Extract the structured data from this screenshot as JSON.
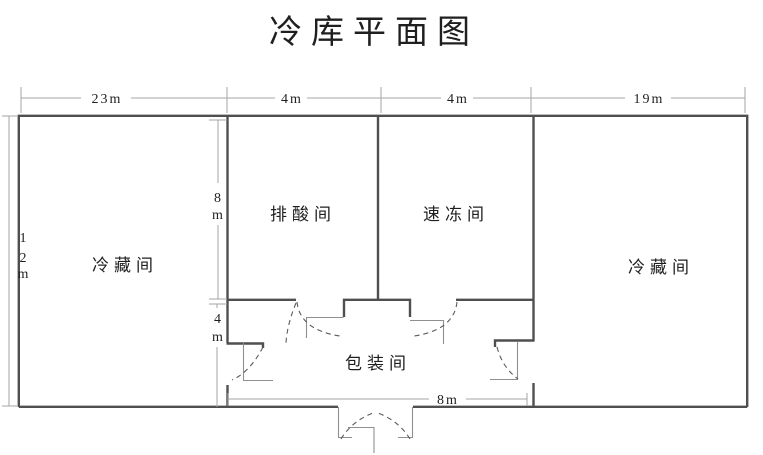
{
  "title": "冷库平面图",
  "dimensions": {
    "top": [
      {
        "label": "23m"
      },
      {
        "label": "4m"
      },
      {
        "label": "4m"
      },
      {
        "label": "19m"
      }
    ],
    "left": {
      "label": "12m",
      "chars": [
        "1",
        "2",
        "m"
      ]
    },
    "middle_upper": {
      "label": "8m",
      "chars": [
        "8",
        "m"
      ]
    },
    "middle_lower": {
      "label": "4m",
      "chars": [
        "4",
        "m"
      ]
    },
    "bottom": {
      "label": "8m"
    }
  },
  "rooms": {
    "left_cold_storage": "冷藏间",
    "acid_removal": "排酸间",
    "quick_freeze": "速冻间",
    "right_cold_storage": "冷藏间",
    "packing": "包装间"
  },
  "colors": {
    "wall": "#4f4f4f",
    "thin_line": "#8f8f8f",
    "door_swing": "#5a5a5a",
    "dimension_line": "#a6a6a6",
    "text": "#1f1f1f",
    "background": "#ffffff"
  }
}
